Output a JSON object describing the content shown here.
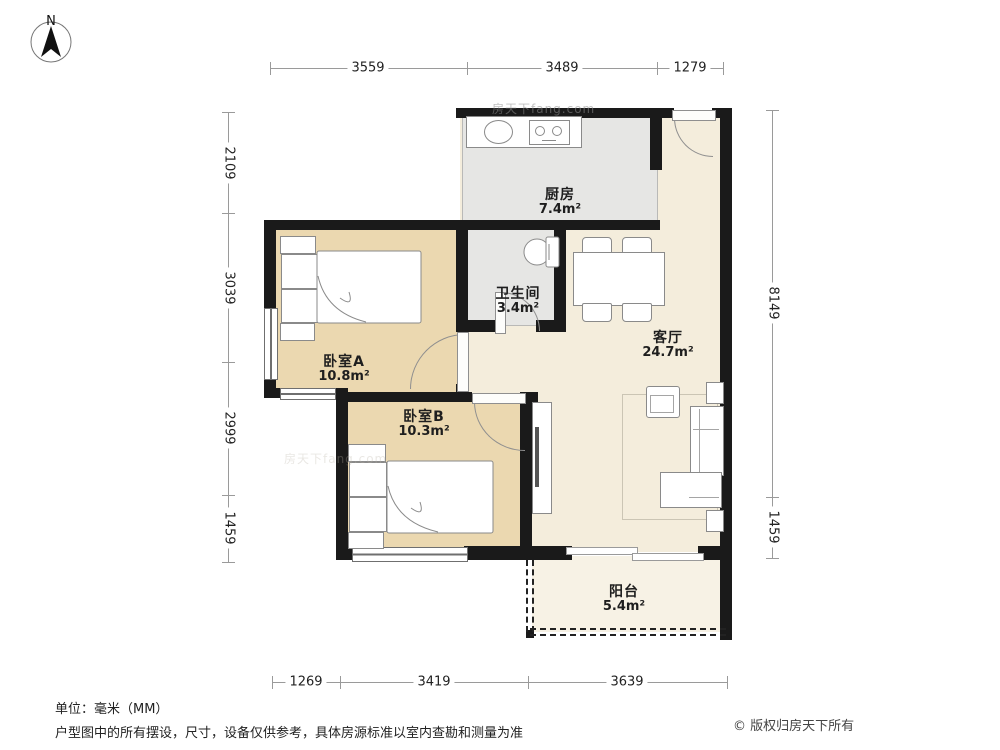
{
  "compass": {
    "label": "N"
  },
  "watermark": {
    "text": "房天下fang.com"
  },
  "rooms": {
    "kitchen": {
      "name": "厨房",
      "area": "7.4m²"
    },
    "bathroom": {
      "name": "卫生间",
      "area": "3.4m²"
    },
    "living": {
      "name": "客厅",
      "area": "24.7m²"
    },
    "bedroomA": {
      "name": "卧室A",
      "area": "10.8m²"
    },
    "bedroomB": {
      "name": "卧室B",
      "area": "10.3m²"
    },
    "balcony": {
      "name": "阳台",
      "area": "5.4m²"
    }
  },
  "dimensions": {
    "unit_note": "mm",
    "top": [
      "3559",
      "3489",
      "1279"
    ],
    "bottom": [
      "1269",
      "3419",
      "3639"
    ],
    "left": [
      "2109",
      "3039",
      "2999",
      "1459"
    ],
    "right": [
      "8149",
      "1459"
    ]
  },
  "footer": {
    "unit": "单位：毫米（MM）",
    "disclaimer": "户型图中的所有摆设，尺寸，设备仅供参考，具体房源标准以室内查勘和测量为准",
    "copyright": "© 版权归房天下所有"
  }
}
